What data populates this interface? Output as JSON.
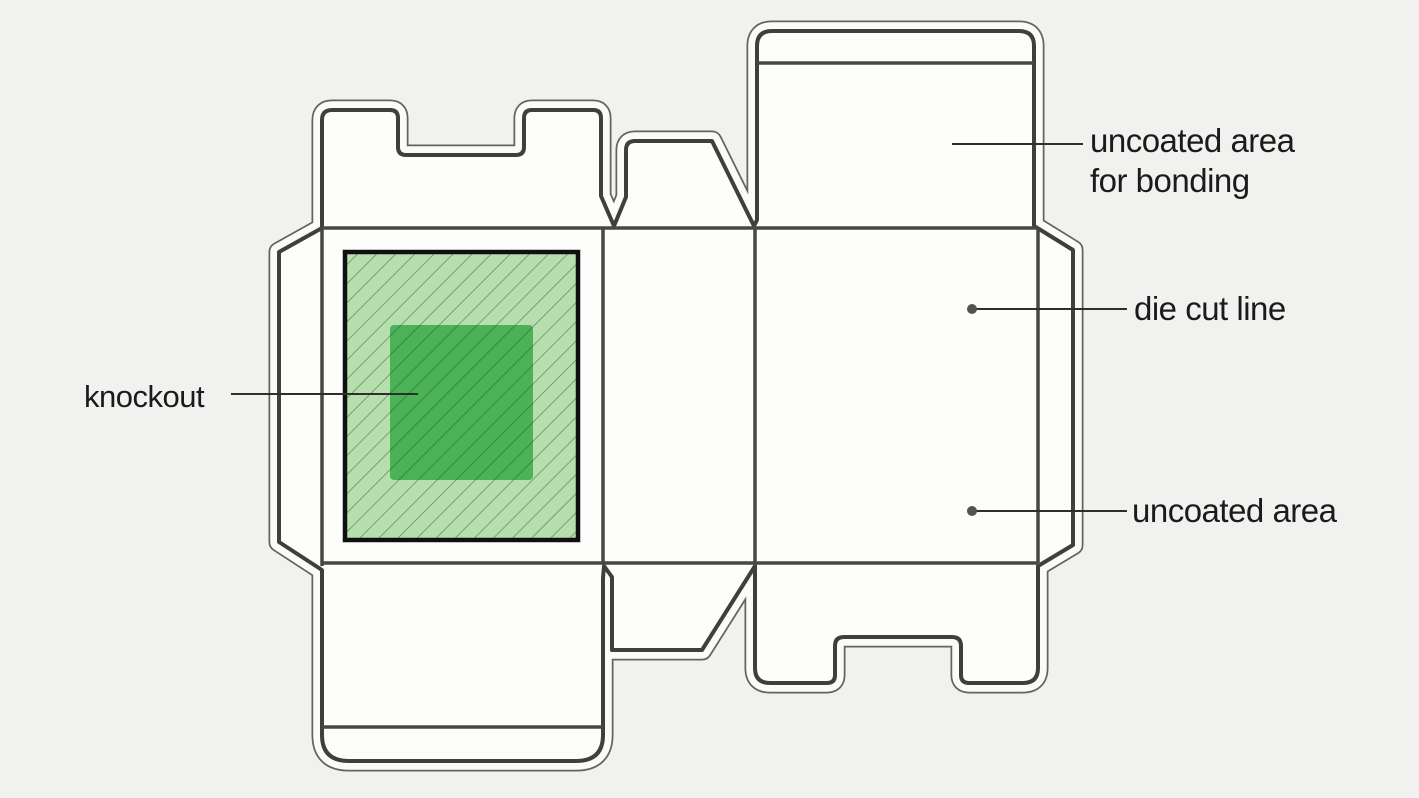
{
  "figure": {
    "type": "packaging-dieline-diagram",
    "background_color": "#f1f1ef",
    "panel_color": "#fdfdfb",
    "dieline_color": "#3e403e",
    "labels": {
      "knockout": {
        "text": "knockout"
      },
      "uncoated_bonding": {
        "lines": [
          "uncoated area",
          "for bonding"
        ]
      },
      "die_cut": {
        "text": "die cut line"
      },
      "uncoated": {
        "text": "uncoated area"
      }
    },
    "knockout_colors": {
      "outer_fill": "#b7dfae",
      "inner_fill": "#4bb257",
      "border": "#101010"
    }
  }
}
